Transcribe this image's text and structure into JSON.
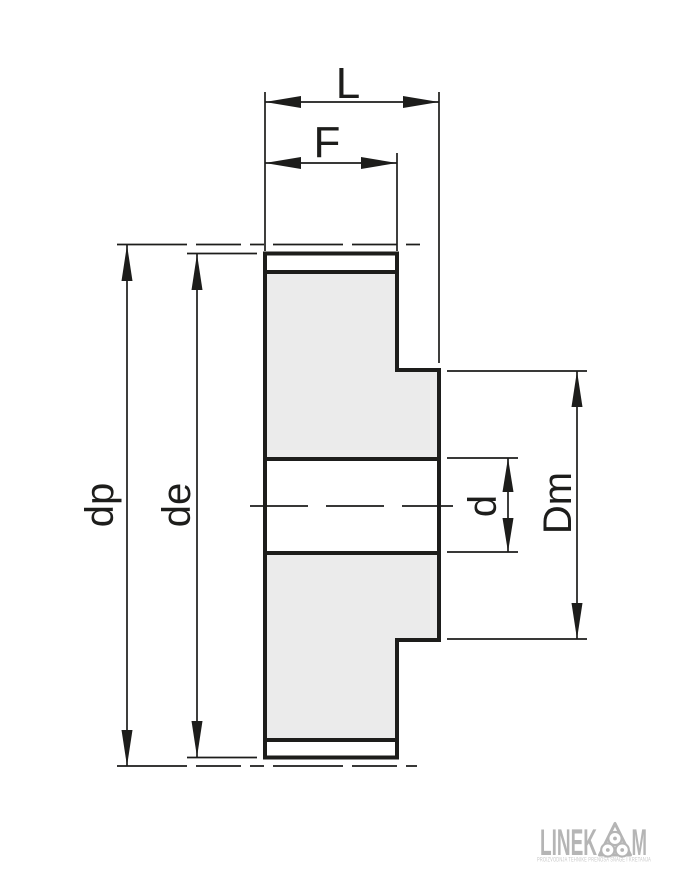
{
  "drawing": {
    "type": "timing-pulley-cross-section",
    "labels": {
      "overall_width": "L",
      "face_width": "F",
      "pitch_diameter": "dp",
      "outside_diameter": "de",
      "bore_diameter": "d",
      "hub_diameter": "Dm"
    },
    "colors": {
      "line": "#1d1d1b",
      "section_fill": "#ebebeb",
      "background": "#ffffff"
    }
  },
  "logo": {
    "wordmark_left": "LINEK",
    "wordmark_right": "M",
    "badge_icon": "three-pulley-belt-icon",
    "tagline": "PROIZVODNJA TEHNIKE PRENOSA SNAGE I KRETANJA",
    "color": "#b5b5b5",
    "tagline_color": "#c8c8c8"
  }
}
